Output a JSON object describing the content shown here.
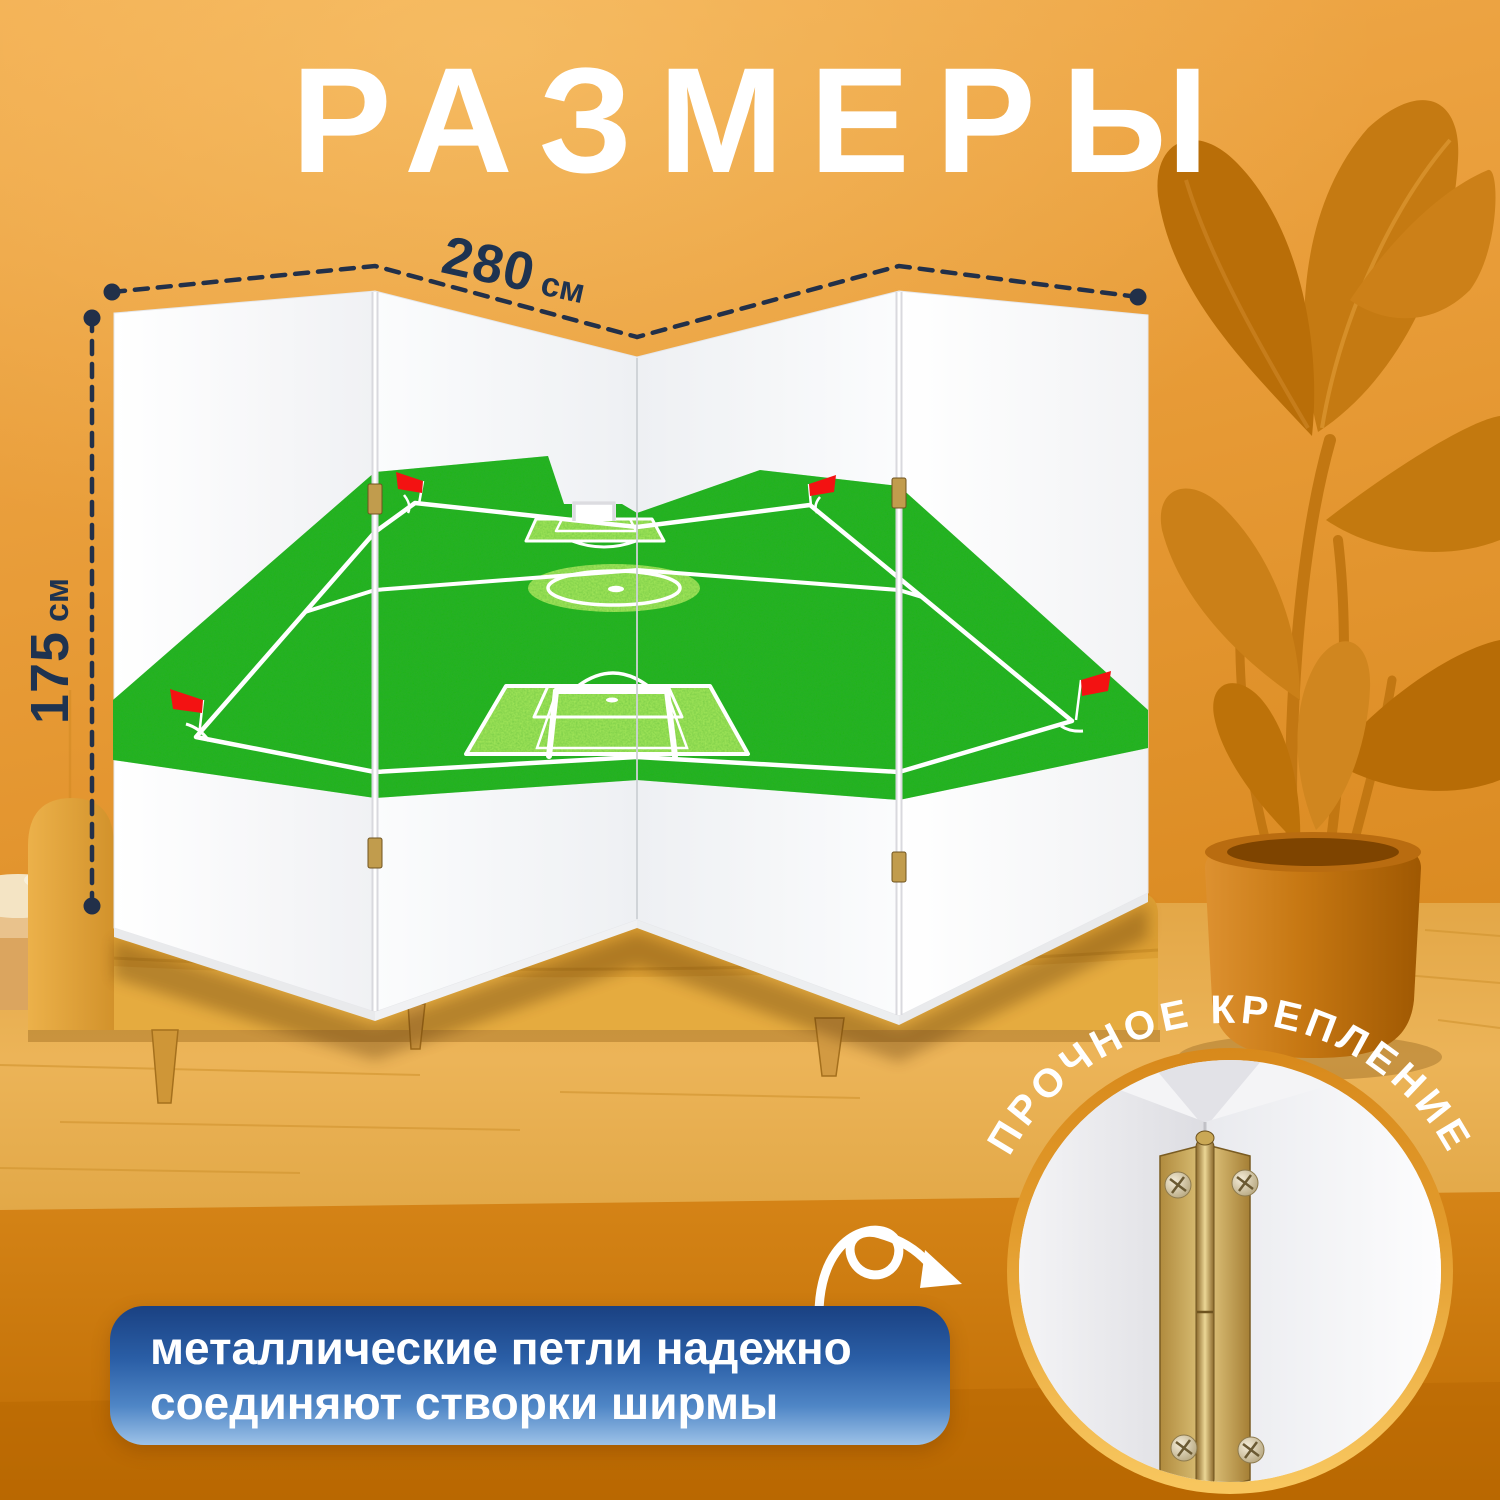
{
  "title": "РАЗМЕРЫ",
  "dimensions": {
    "width": {
      "value": "280",
      "unit": "см"
    },
    "height": {
      "value": "175",
      "unit": "см"
    }
  },
  "badge": {
    "curved_label": "ПРОЧНОЕ КРЕПЛЕНИЕ"
  },
  "callout": {
    "line1": "металлические петли надежно",
    "line2": "соединяют створки ширмы"
  },
  "screen": {
    "panel_count": 4
  },
  "colors": {
    "accent_navy": "#1e3350",
    "background_orange": "#e29a35",
    "callout_blue_top": "#1a4182",
    "callout_blue_bottom": "#9dc2e8",
    "field_green": "#24b31f",
    "field_light_green": "#a5e95c",
    "flag_red": "#f31212",
    "hinge_brass": "#b08d41",
    "text_white": "#ffffff"
  }
}
